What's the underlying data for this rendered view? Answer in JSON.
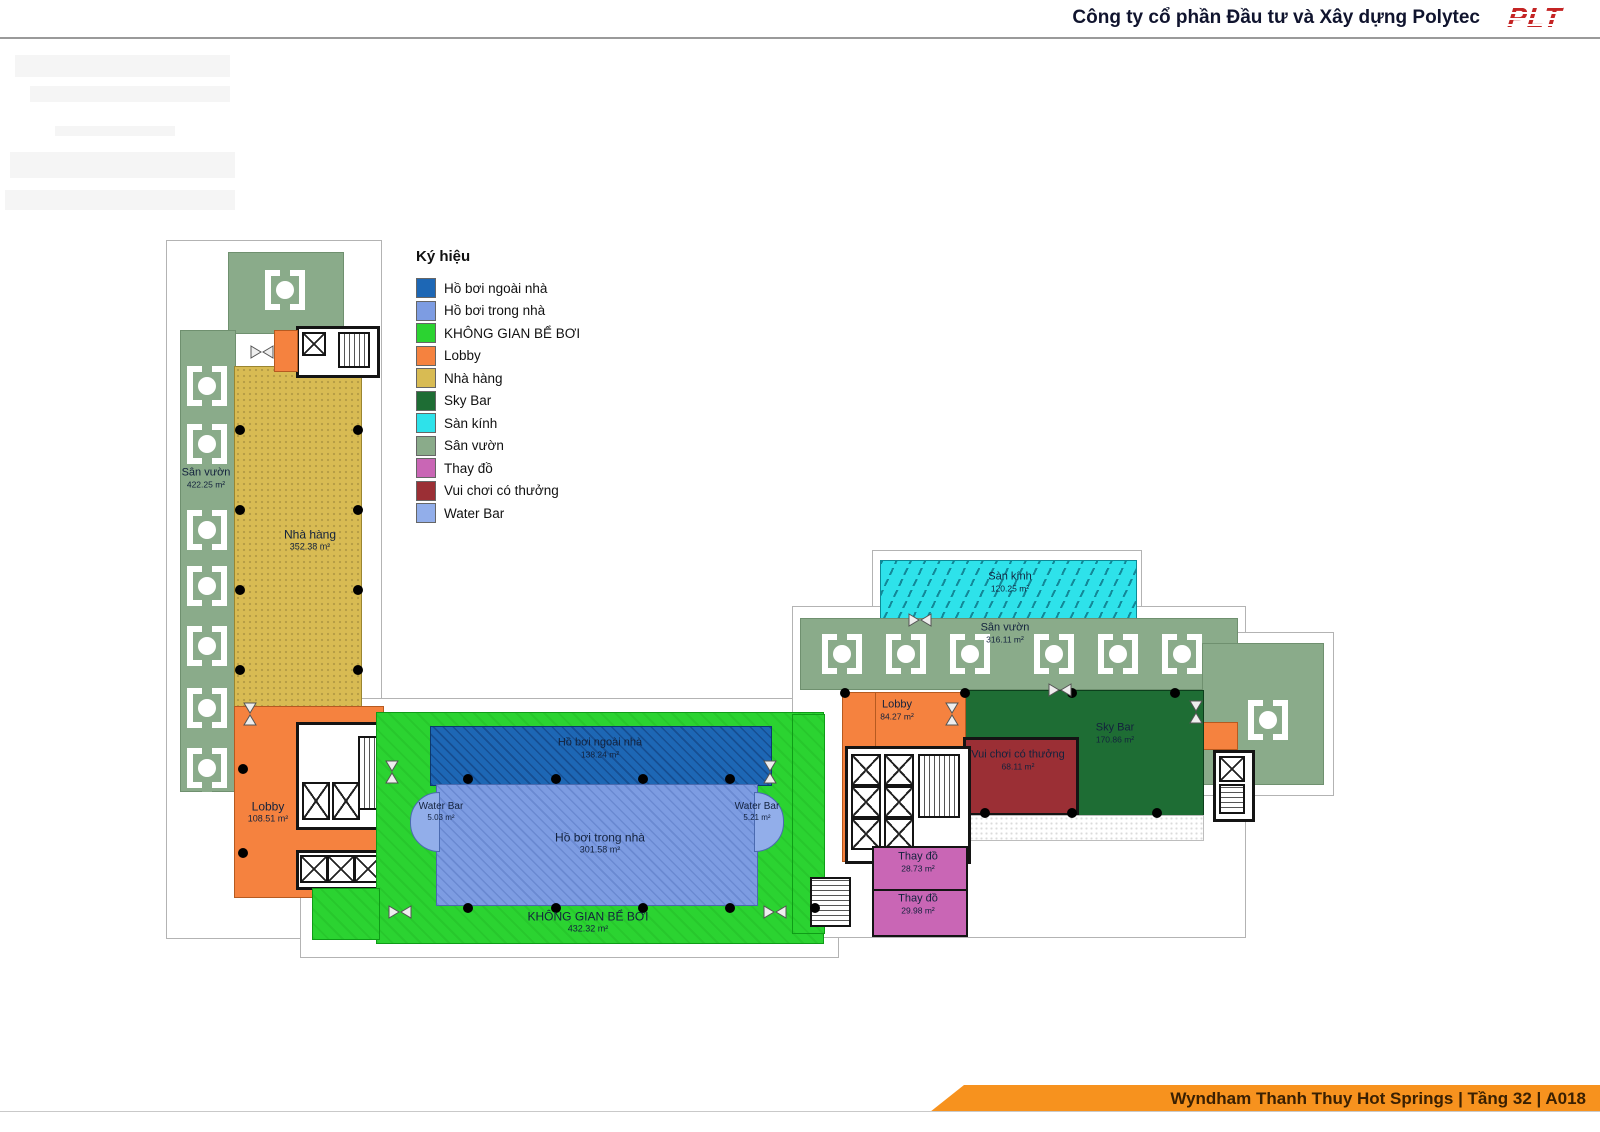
{
  "header": {
    "company": "Công ty cổ phần Đầu tư và Xây dựng Polytec",
    "logo_text": "PLT"
  },
  "footer": {
    "label": "Wyndham Thanh Thuy Hot Springs | Tầng 32 | A018"
  },
  "legend": {
    "title": "Ký hiệu",
    "items": [
      {
        "label": "Hồ bơi ngoài nhà",
        "color": "#1d67b5"
      },
      {
        "label": "Hồ bơi trong nhà",
        "color": "#7d9ce2"
      },
      {
        "label": "KHÔNG GIAN BỂ BƠI",
        "color": "#2bd331"
      },
      {
        "label": "Lobby",
        "color": "#f5823f"
      },
      {
        "label": "Nhà hàng",
        "color": "#d8bb53"
      },
      {
        "label": "Sky Bar",
        "color": "#1e6d34"
      },
      {
        "label": "Sàn kính",
        "color": "#2ee2ea"
      },
      {
        "label": "Sân vườn",
        "color": "#8aab8a"
      },
      {
        "label": "Thay đồ",
        "color": "#c966b5"
      },
      {
        "label": "Vui chơi có thưởng",
        "color": "#9b2f35"
      },
      {
        "label": "Water Bar",
        "color": "#92aeea"
      }
    ]
  },
  "rooms": {
    "garden_left": {
      "name": "Sân vườn",
      "area": "422.25 m²"
    },
    "restaurant": {
      "name": "Nhà hàng",
      "area": "352.38 m²"
    },
    "lobby_left": {
      "name": "Lobby",
      "area": "108.51 m²"
    },
    "pool_outdoor": {
      "name": "Hồ bơi ngoài nhà",
      "area": "138.24 m²"
    },
    "pool_indoor": {
      "name": "Hồ bơi trong nhà",
      "area": "301.58 m²"
    },
    "water_bar_left": {
      "name": "Water Bar",
      "area": "5.03 m²"
    },
    "water_bar_right": {
      "name": "Water Bar",
      "area": "5.21 m²"
    },
    "pool_space": {
      "name": "KHÔNG GIAN BỂ BƠI",
      "area": "432.32 m²"
    },
    "glass_floor": {
      "name": "Sàn kính",
      "area": "120.25 m²"
    },
    "garden_right": {
      "name": "Sân vườn",
      "area": "316.11 m²"
    },
    "lobby_right": {
      "name": "Lobby",
      "area": "84.27 m²"
    },
    "sky_bar": {
      "name": "Sky Bar",
      "area": "170.86 m²"
    },
    "game_room": {
      "name": "Vui chơi có thưởng",
      "area": "68.11 m²"
    },
    "changing_room_1": {
      "name": "Thay đồ",
      "area": "28.73 m²"
    },
    "changing_room_2": {
      "name": "Thay đồ",
      "area": "29.98 m²"
    }
  }
}
